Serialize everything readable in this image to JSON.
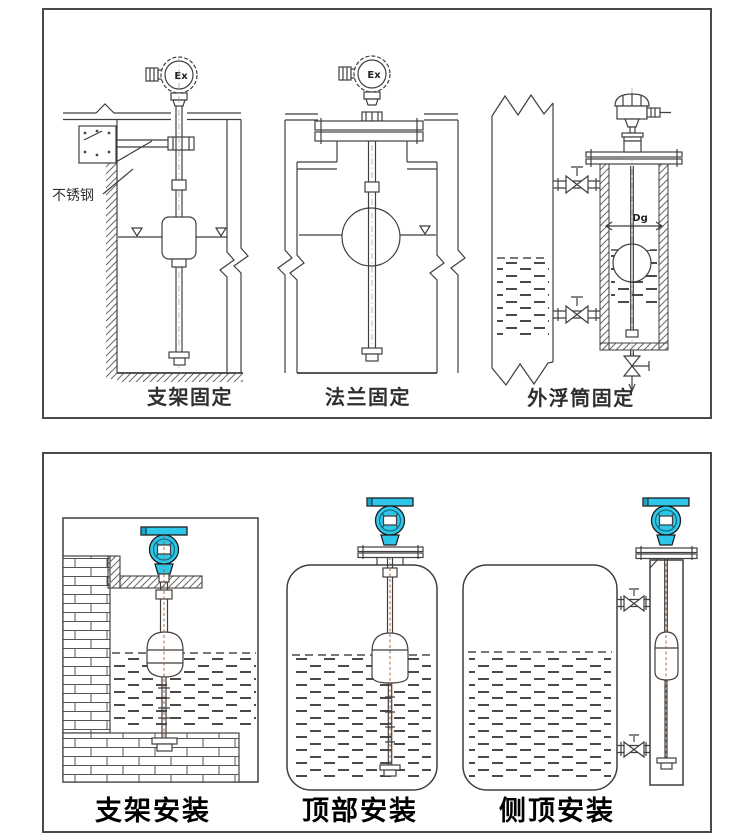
{
  "panel_top": {
    "captions": {
      "bracket": "支架固定",
      "flange": "法兰固定",
      "external_chamber": "外浮筒固定"
    },
    "labels": {
      "stainless_steel": "不锈钢",
      "ex_left": "Ex",
      "ex_middle": "Ex",
      "dg": "Dg"
    }
  },
  "panel_bottom": {
    "captions": {
      "bracket": "支架安装",
      "top_mount": "顶部安装",
      "side_top_mount": "侧顶安装"
    }
  },
  "colors": {
    "transmitter_cyan": "#2ec7e9",
    "line_dark": "#3f3f3f",
    "float_centerline_red": "#b05a28",
    "panel_border": "#4a4a4a"
  }
}
